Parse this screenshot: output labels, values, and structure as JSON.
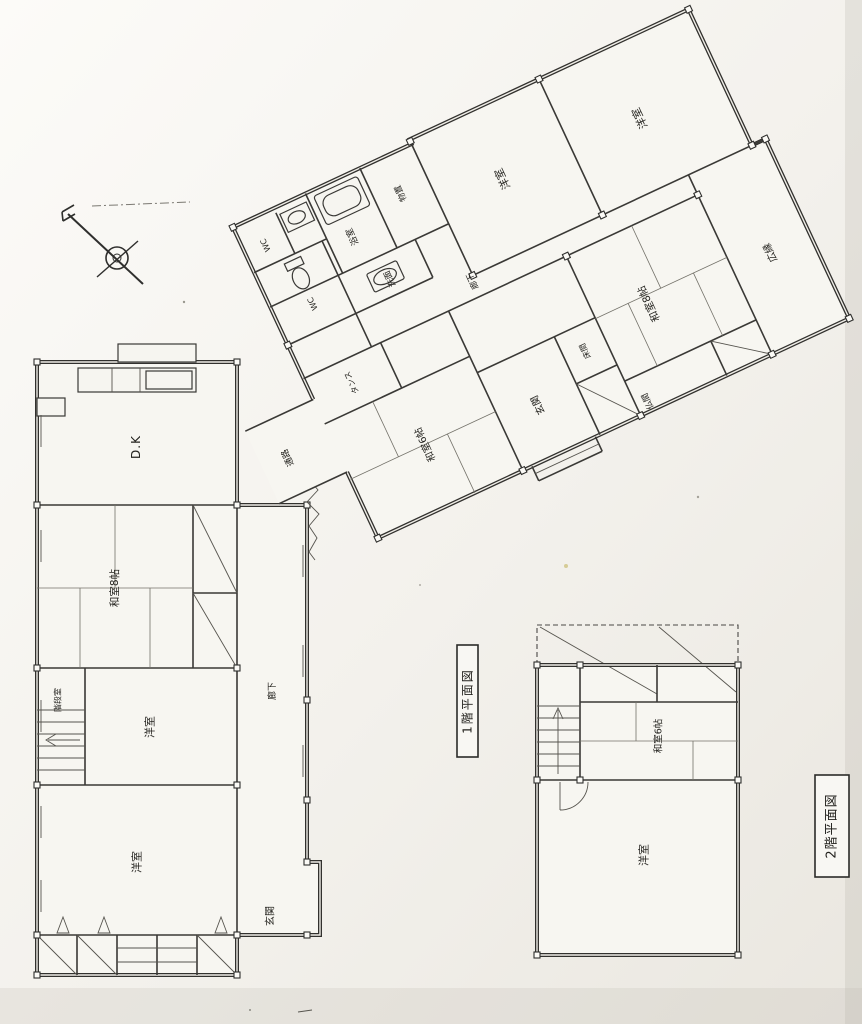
{
  "captions": {
    "floor1": "1階平面図",
    "floor2": "2階平面図"
  },
  "floor1": {
    "left_wing": {
      "rooms": [
        {
          "label": "D.K"
        },
        {
          "label": "和室8帖"
        },
        {
          "label": "階段室"
        },
        {
          "label": "洋室"
        },
        {
          "label": "洋室"
        },
        {
          "label": "廊下"
        },
        {
          "label": "玄関"
        }
      ]
    },
    "rotated_wing": {
      "rooms": [
        {
          "label": "WC"
        },
        {
          "label": "浴室"
        },
        {
          "label": "物置"
        },
        {
          "label": "洋室"
        },
        {
          "label": "洋室"
        },
        {
          "label": "WC"
        },
        {
          "label": "洗面"
        },
        {
          "label": "廊下"
        },
        {
          "label": "タンス"
        },
        {
          "label": "通路"
        },
        {
          "label": "和室6帖"
        },
        {
          "label": "玄関"
        },
        {
          "label": "床間"
        },
        {
          "label": "和室8帖"
        },
        {
          "label": "仏間"
        },
        {
          "label": "広縁"
        }
      ]
    }
  },
  "floor2": {
    "rooms": [
      {
        "label": "和室6帖"
      },
      {
        "label": "洋室"
      }
    ]
  },
  "colors": {
    "paper": "#f2efe9",
    "ink": "#2f2f2d"
  }
}
